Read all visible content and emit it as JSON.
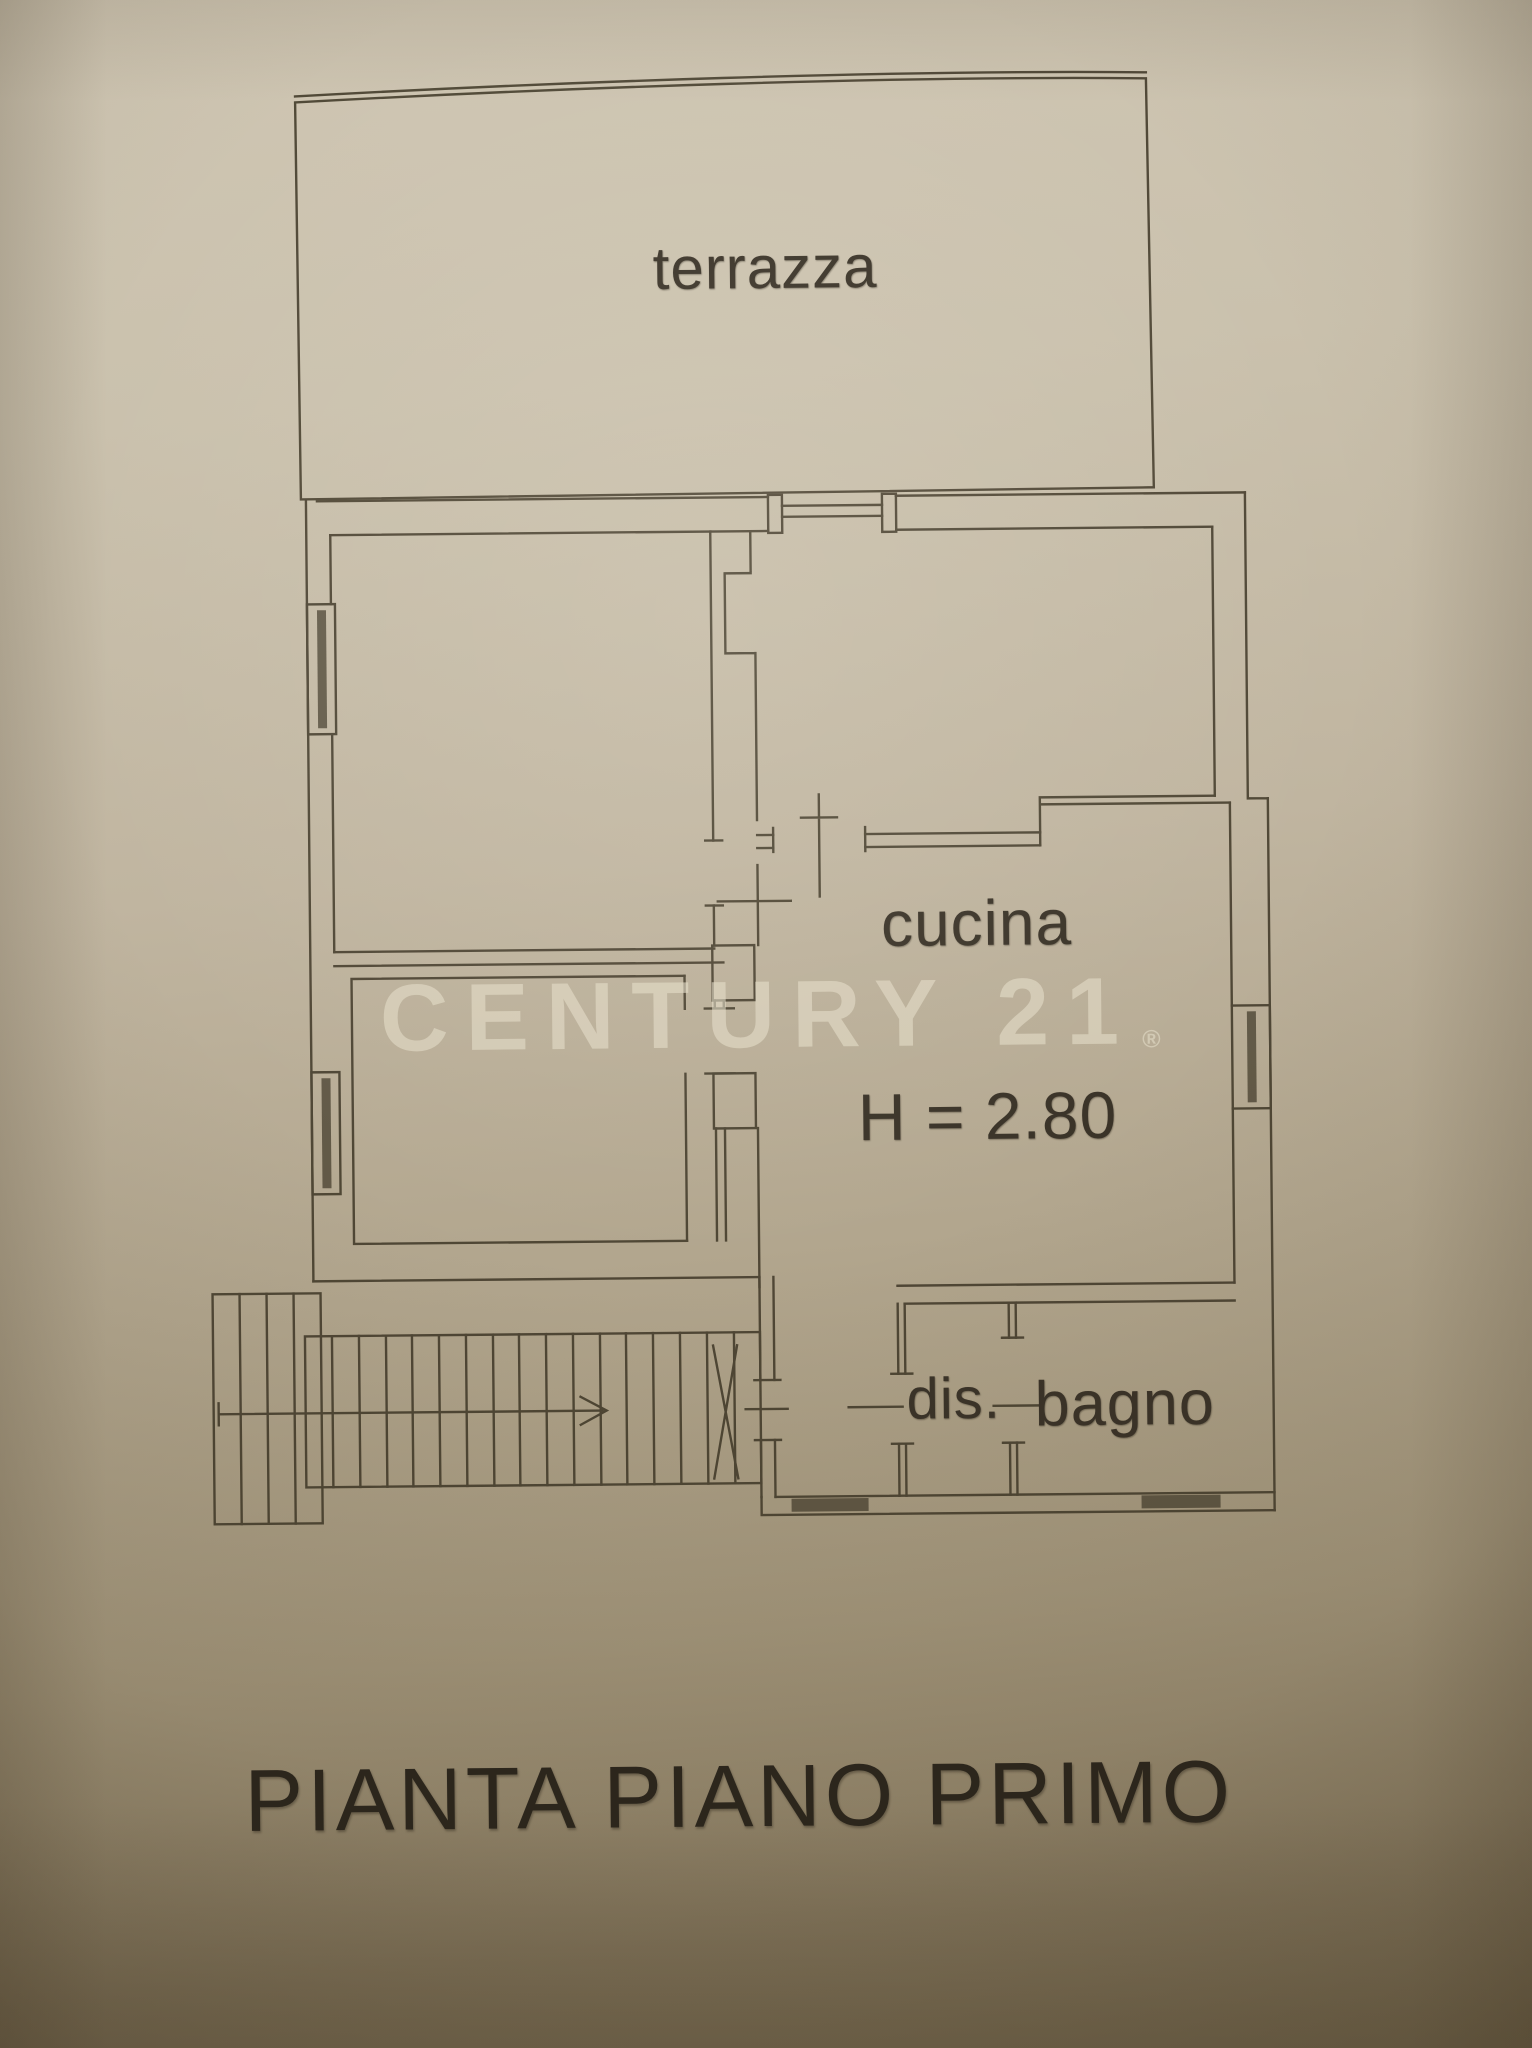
{
  "photo": {
    "paper_top_color": "#cfc6b3",
    "paper_bottom_color": "#887a5e",
    "ink_color": "#473f2e",
    "text_ink_color": "#3a3328"
  },
  "floor_plan": {
    "title": "PIANTA PIANO PRIMO",
    "watermark": {
      "text": "CENTURY 21",
      "registered_mark": "®",
      "color": "#e6dfca"
    },
    "labels": {
      "terrace": "terrazza",
      "kitchen": "cucina",
      "kitchen_ceiling_height": "H = 2.80",
      "hallway": "dis.",
      "bathroom": "bagno"
    }
  }
}
